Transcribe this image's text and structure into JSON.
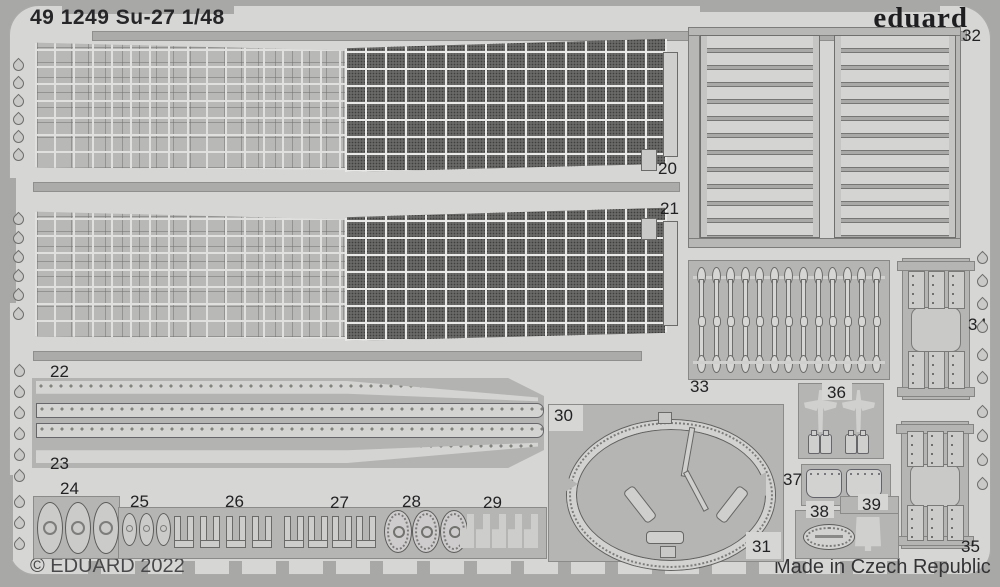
{
  "sheet": {
    "title": "49 1249 Su-27 1/48",
    "brand": "eduard",
    "copyright": "© EDUARD 2022",
    "made_in": "Made in Czech Republic"
  },
  "labels": {
    "20": "20",
    "21": "21",
    "22": "22",
    "23": "23",
    "24": "24",
    "25": "25",
    "26": "26",
    "27": "27",
    "28": "28",
    "29": "29",
    "30": "30",
    "31": "31",
    "32": "32",
    "33": "33",
    "34": "34",
    "35": "35",
    "36": "36",
    "37": "37",
    "38": "38",
    "39": "39"
  },
  "colors": {
    "frame": "#a8a8a6",
    "sheet": "#d6d6d4",
    "carrier": "#b5b5b3",
    "part_light": "#d2d2d0",
    "mesh_dark": "#5e5e5c",
    "text": "#222224"
  }
}
